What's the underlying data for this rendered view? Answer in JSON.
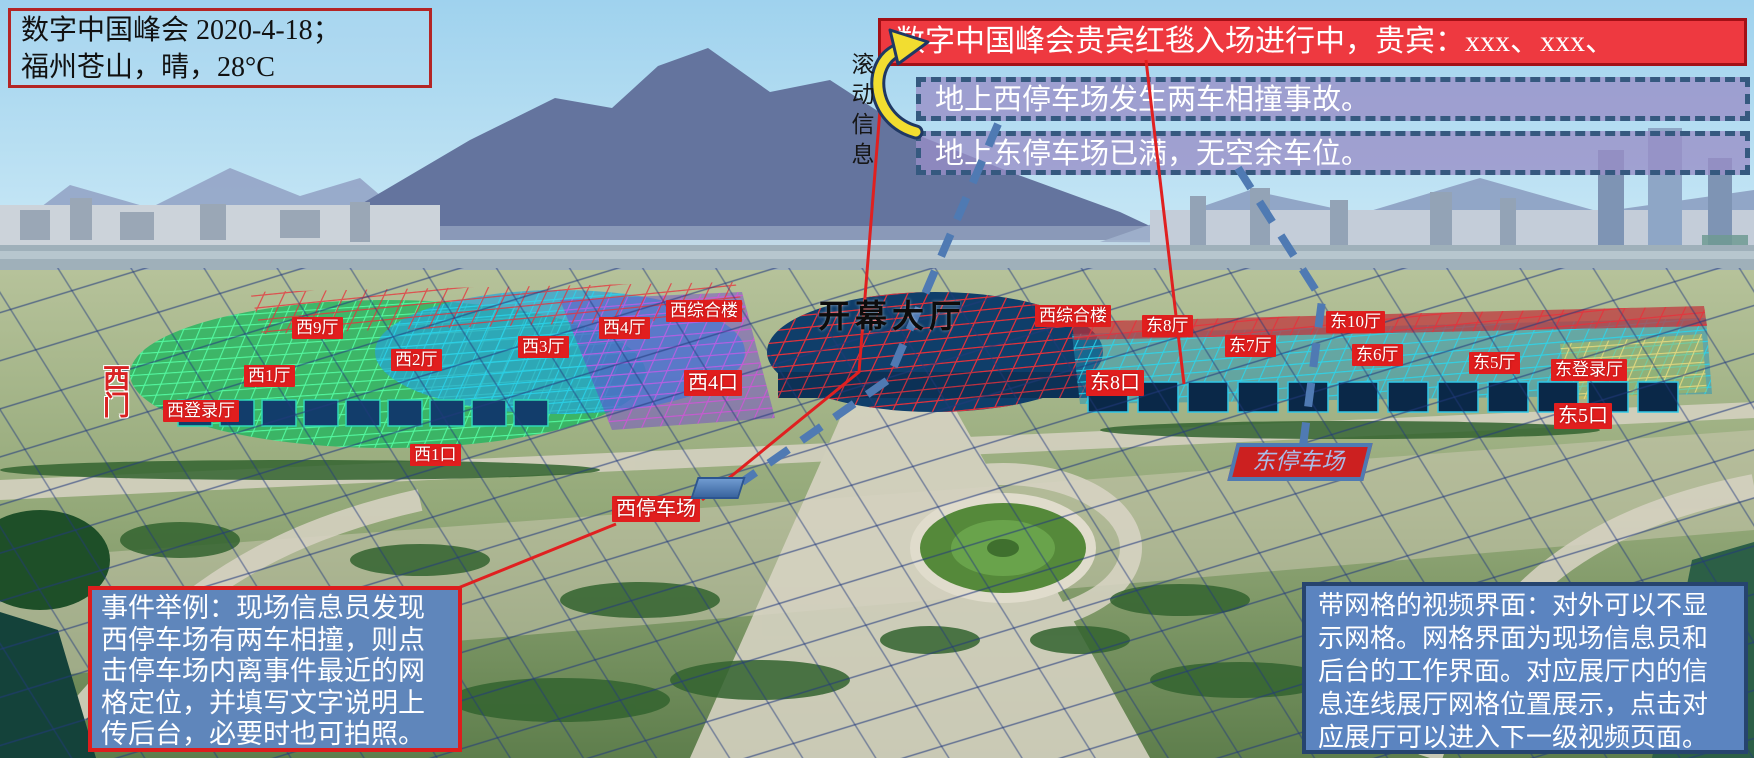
{
  "header": {
    "event_info": {
      "line1": "数字中国峰会 2020-4-18；",
      "line2": "福州苍山，晴，28°C"
    },
    "scroll_label": "滚动信息",
    "banners": [
      {
        "type": "live",
        "text": "数字中国峰会贵宾红毯入场进行中，贵宾：xxx、xxx、"
      },
      {
        "type": "alert",
        "text": "地上西停车场发生两车相撞事故。"
      },
      {
        "type": "alert",
        "text": "地上东停车场已满，无空余车位。"
      }
    ]
  },
  "map": {
    "main_hall_label": "开幕大厅",
    "west_gate_label": "西门",
    "east_parking_label": "东停车场",
    "venue_labels": [
      {
        "name": "west-hall-9",
        "label": "西9厅"
      },
      {
        "name": "west-hall-2",
        "label": "西2厅"
      },
      {
        "name": "west-hall-1",
        "label": "西1厅"
      },
      {
        "name": "west-registration-hall",
        "label": "西登录厅"
      },
      {
        "name": "west-hall-3",
        "label": "西3厅"
      },
      {
        "name": "west-hall-4",
        "label": "西4厅"
      },
      {
        "name": "west-complex-building",
        "label": "西综合楼"
      },
      {
        "name": "west-gate-4",
        "label": "西4口"
      },
      {
        "name": "west-complex-building-2",
        "label": "西综合楼"
      },
      {
        "name": "east-hall-8",
        "label": "东8厅"
      },
      {
        "name": "east-hall-7",
        "label": "东7厅"
      },
      {
        "name": "east-hall-10",
        "label": "东10厅"
      },
      {
        "name": "east-hall-6",
        "label": "东6厅"
      },
      {
        "name": "east-hall-5",
        "label": "东5厅"
      },
      {
        "name": "east-registration-hall",
        "label": "东登录厅"
      },
      {
        "name": "east-gate-5",
        "label": "东5口"
      },
      {
        "name": "east-gate-8",
        "label": "东8口"
      },
      {
        "name": "west-gate-1",
        "label": "西1口"
      },
      {
        "name": "west-parking",
        "label": "西停车场"
      }
    ]
  },
  "notes": {
    "event_example": "事件举例：现场信息员发现西停车场有两车相撞，则点击停车场内离事件最近的网格定位，并填写文字说明上传后台，必要时也可拍照。",
    "grid_note": "带网格的视频界面：对外可以不显示网格。网格界面为现场信息员和后台的工作界面。对应展厅内的信息连线展厅网格位置展示，点击对应展厅可以进入下一级视频页面。"
  },
  "colors": {
    "label_red": "#e11e1e",
    "banner_red": "#ee3940",
    "alert_banner_fill": "#988ec6",
    "alert_banner_border": "#35597f",
    "note_box_blue": "#5f86bb",
    "note_left_border": "#dd1d1d",
    "note_right_border": "#26446e",
    "arrow_yellow": "#f2dd30",
    "connector_red": "#e02020",
    "connector_blue": "#4f7ab3"
  }
}
